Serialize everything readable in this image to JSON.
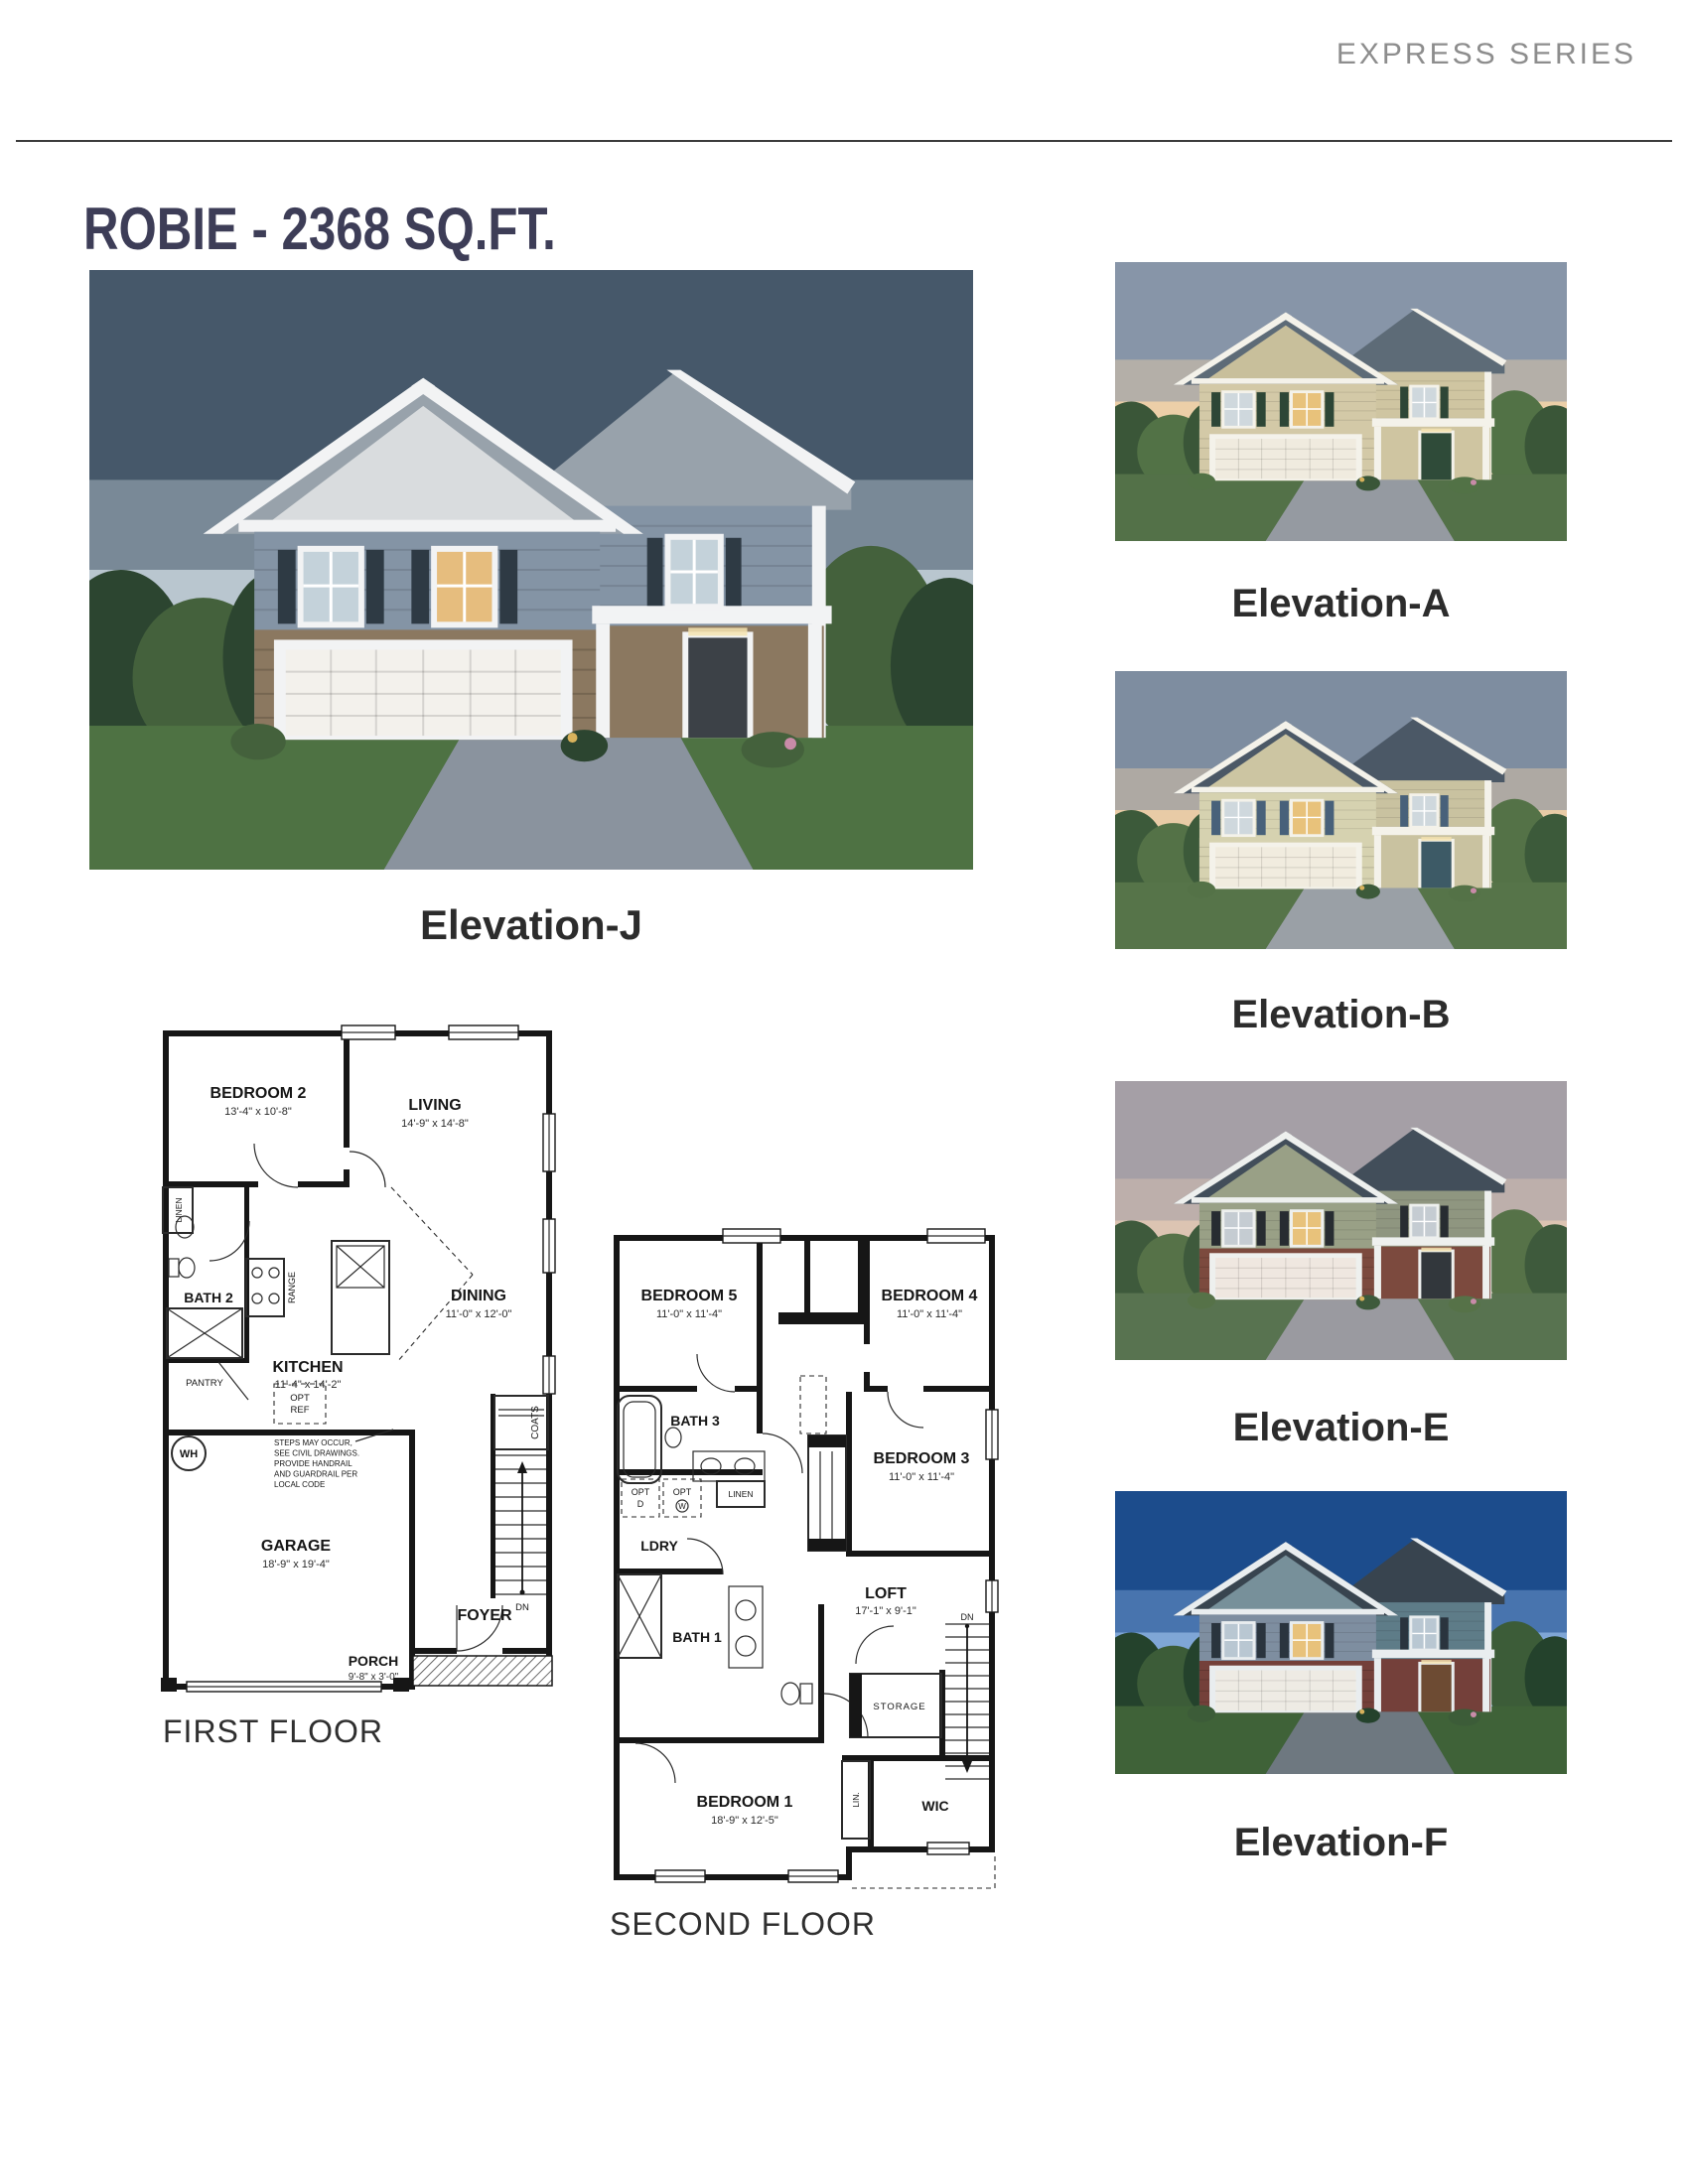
{
  "page": {
    "series_label": "EXPRESS SERIES",
    "title": "ROBIE - 2368 SQ.FT."
  },
  "hero": {
    "label": "Elevation-J",
    "colors": {
      "sky1": "#46586a",
      "sky2": "#b9c6cf",
      "tree1": "#2c4530",
      "tree2": "#44613c",
      "grass": "#4e7243",
      "drive": "#8a939e",
      "roof": "#98a2ab",
      "gable": "#d9dcde",
      "siding": "#8494a5",
      "siding2": "#8494a5",
      "lower": "#8b7860",
      "lower2": "#8b7860",
      "garage": "#f3f1ec",
      "door": "#3c4147",
      "shutter": "#2e3a44",
      "trim": "#f2f3f4",
      "win": "#c4d2da",
      "winlit": "#e6bd7e"
    }
  },
  "elevations": [
    {
      "label": "Elevation-A",
      "colors": {
        "sky1": "#8795a8",
        "sky2": "#eccfa8",
        "tree1": "#3a5638",
        "tree2": "#527246",
        "grass": "#537148",
        "drive": "#959aa1",
        "roof": "#5d6b77",
        "gable": "#c8bf9b",
        "siding": "#d3c9a7",
        "siding2": "#cfc5a1",
        "lower": "#d3c9a7",
        "lower2": "#cfc5a1",
        "garage": "#f0ebdf",
        "door": "#2f4b39",
        "shutter": "#2d4636",
        "trim": "#f4f2ea",
        "win": "#cfd8dd",
        "winlit": "#e8c27b"
      }
    },
    {
      "label": "Elevation-B",
      "colors": {
        "sky1": "#7e8da0",
        "sky2": "#e8cba6",
        "tree1": "#3c5a3a",
        "tree2": "#547247",
        "grass": "#567449",
        "drive": "#9aa0a6",
        "roof": "#4b5866",
        "gable": "#ccc5a2",
        "siding": "#d6d2b0",
        "siding2": "#c9c2a0",
        "lower": "#d6d2b0",
        "lower2": "#c9c2a0",
        "garage": "#f1ecdf",
        "door": "#3d5a66",
        "shutter": "#48617a",
        "trim": "#f4f2ea",
        "win": "#cfd8dd",
        "winlit": "#e8c27b"
      }
    },
    {
      "label": "Elevation-E",
      "colors": {
        "sky1": "#a59fa6",
        "sky2": "#dcc4b2",
        "tree1": "#3e5a3c",
        "tree2": "#567248",
        "grass": "#587350",
        "drive": "#9a9aa0",
        "roof": "#424e5a",
        "gable": "#99a086",
        "siding": "#99a086",
        "siding2": "#8f9680",
        "lower": "#7c4a3e",
        "lower2": "#7c4a3e",
        "garage": "#efe7e0",
        "door": "#32373c",
        "shutter": "#272c31",
        "trim": "#eef0ee",
        "win": "#c5ccd2",
        "winlit": "#e8c27b"
      }
    },
    {
      "label": "Elevation-F",
      "colors": {
        "sky1": "#1c4c8c",
        "sky2": "#7fa6d6",
        "tree1": "#24422c",
        "tree2": "#3c5c38",
        "grass": "#3f6238",
        "drive": "#6e7880",
        "roof": "#38444f",
        "gable": "#77909a",
        "siding": "#7e8ea0",
        "siding2": "#5e7c88",
        "lower": "#74403a",
        "lower2": "#74403a",
        "garage": "#eeebe4",
        "door": "#6d4b33",
        "shutter": "#2a343e",
        "trim": "#e9edef",
        "win": "#b9c7d2",
        "winlit": "#e8c27b"
      }
    }
  ],
  "first_floor": {
    "label": "FIRST FLOOR",
    "rooms": {
      "bedroom2": {
        "name": "BEDROOM 2",
        "dims": "13'-4\" x 10'-8\""
      },
      "living": {
        "name": "LIVING",
        "dims": "14'-9\" x 14'-8\""
      },
      "dining": {
        "name": "DINING",
        "dims": "11'-0\" x 12'-0\""
      },
      "kitchen": {
        "name": "KITCHEN",
        "dims": "11'-4\" x 14'-2\""
      },
      "garage": {
        "name": "GARAGE",
        "dims": "18'-9\" x 19'-4\""
      },
      "porch": {
        "name": "PORCH",
        "dims": "9'-8\" x 3'-0\""
      },
      "foyer": {
        "name": "FOYER"
      },
      "bath2": {
        "name": "BATH 2"
      }
    },
    "small_labels": {
      "linen": "LINEN",
      "pantry": "PANTRY",
      "range": "RANGE",
      "opt_ref_1": "OPT",
      "opt_ref_2": "REF",
      "wh": "WH",
      "coats": "COATS",
      "dn": "DN"
    },
    "note_lines": [
      "STEPS MAY OCCUR,",
      "SEE CIVIL DRAWINGS.",
      "PROVIDE HANDRAIL",
      "AND GUARDRAIL PER",
      "LOCAL CODE"
    ]
  },
  "second_floor": {
    "label": "SECOND FLOOR",
    "rooms": {
      "bedroom5": {
        "name": "BEDROOM 5",
        "dims": "11'-0\" x 11'-4\""
      },
      "bedroom4": {
        "name": "BEDROOM 4",
        "dims": "11'-0\" x 11'-4\""
      },
      "bedroom3": {
        "name": "BEDROOM 3",
        "dims": "11'-0\" x 11'-4\""
      },
      "bedroom1": {
        "name": "BEDROOM 1",
        "dims": "18'-9\" x 12'-5\""
      },
      "loft": {
        "name": "LOFT",
        "dims": "17'-1\" x 9'-1\""
      },
      "bath3": {
        "name": "BATH 3"
      },
      "bath1": {
        "name": "BATH 1"
      },
      "ldry": {
        "name": "LDRY"
      },
      "wic": {
        "name": "WIC"
      }
    },
    "small_labels": {
      "opt_d_1": "OPT",
      "opt_d_2": "D",
      "opt_w_1": "OPT",
      "opt_w_2": "W",
      "linen": "LINEN",
      "storage": "STORAGE",
      "lin": "LIN.",
      "dn": "DN"
    }
  }
}
